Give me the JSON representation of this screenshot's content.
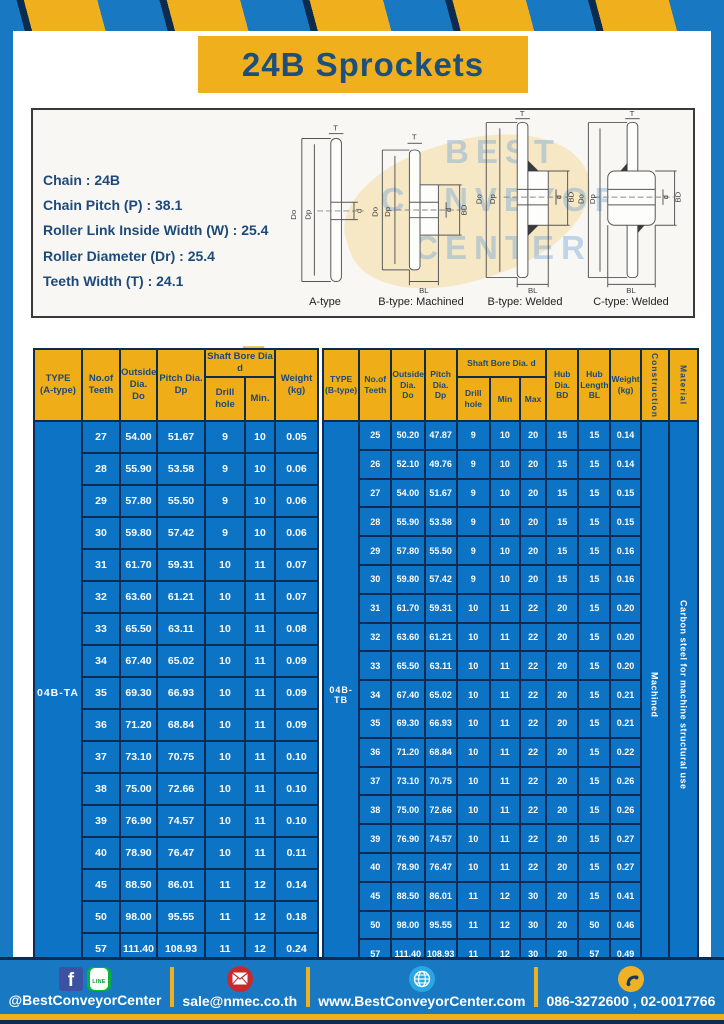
{
  "title": "24B Sprockets",
  "specs": {
    "lines": [
      "Chain : 24B",
      "Chain Pitch (P) : 38.1",
      "Roller Link Inside Width (W) : 25.4",
      "Roller Diameter (Dr) : 25.4",
      "Teeth Width (T) : 24.1"
    ]
  },
  "dims": {
    "t": "T",
    "do": "Do",
    "dp": "Dp",
    "d": "d",
    "bd": "BD",
    "bl": "BL"
  },
  "diagrams": {
    "captions": [
      "A-type",
      "B-type: Machined",
      "B-type: Welded",
      "C-type: Welded"
    ]
  },
  "watermark": {
    "lines": [
      "BEST",
      "CONVEYOR",
      "CENTER"
    ],
    "mail_glyph": "✉"
  },
  "tables": {
    "left": {
      "type_label": "04B-TA",
      "headers": {
        "type": "TYPE\n(A-type)",
        "teeth": "No.of\nTeeth",
        "outside": "Outside\nDia.\nDo",
        "pitch": "Pitch Dia.\nDp",
        "bore_group": "Shaft Bore Dia d",
        "drill": "Drill hole",
        "min": "Min.",
        "weight": "Weight\n(kg)"
      },
      "rows": [
        [
          "27",
          "54.00",
          "51.67",
          "9",
          "10",
          "0.05"
        ],
        [
          "28",
          "55.90",
          "53.58",
          "9",
          "10",
          "0.06"
        ],
        [
          "29",
          "57.80",
          "55.50",
          "9",
          "10",
          "0.06"
        ],
        [
          "30",
          "59.80",
          "57.42",
          "9",
          "10",
          "0.06"
        ],
        [
          "31",
          "61.70",
          "59.31",
          "10",
          "11",
          "0.07"
        ],
        [
          "32",
          "63.60",
          "61.21",
          "10",
          "11",
          "0.07"
        ],
        [
          "33",
          "65.50",
          "63.11",
          "10",
          "11",
          "0.08"
        ],
        [
          "34",
          "67.40",
          "65.02",
          "10",
          "11",
          "0.09"
        ],
        [
          "35",
          "69.30",
          "66.93",
          "10",
          "11",
          "0.09"
        ],
        [
          "36",
          "71.20",
          "68.84",
          "10",
          "11",
          "0.09"
        ],
        [
          "37",
          "73.10",
          "70.75",
          "10",
          "11",
          "0.10"
        ],
        [
          "38",
          "75.00",
          "72.66",
          "10",
          "11",
          "0.10"
        ],
        [
          "39",
          "76.90",
          "74.57",
          "10",
          "11",
          "0.10"
        ],
        [
          "40",
          "78.90",
          "76.47",
          "10",
          "11",
          "0.11"
        ],
        [
          "45",
          "88.50",
          "86.01",
          "11",
          "12",
          "0.14"
        ],
        [
          "50",
          "98.00",
          "95.55",
          "11",
          "12",
          "0.18"
        ],
        [
          "57",
          "111.40",
          "108.93",
          "11",
          "12",
          "0.24"
        ]
      ]
    },
    "right": {
      "type_label": "04B-TB",
      "construction": "Machined",
      "material": "Carbon steel for machine structural use",
      "headers": {
        "type": "TYPE\n(B-type)",
        "teeth": "No.of\nTeeth",
        "outside": "Outside\nDia.\nDo",
        "pitch": "Pitch\nDia.\nDp",
        "bore_group": "Shaft Bore Dia. d",
        "drill": "Drill hole",
        "min": "Min",
        "max": "Max",
        "hub_dia": "Hub\nDia.\nBD",
        "hub_len": "Hub\nLength\nBL",
        "weight": "Weight\n(kg)",
        "construction": "Construction",
        "material": "Material"
      },
      "rows": [
        [
          "25",
          "50.20",
          "47.87",
          "9",
          "10",
          "20",
          "15",
          "15",
          "0.14"
        ],
        [
          "26",
          "52.10",
          "49.76",
          "9",
          "10",
          "20",
          "15",
          "15",
          "0.14"
        ],
        [
          "27",
          "54.00",
          "51.67",
          "9",
          "10",
          "20",
          "15",
          "15",
          "0.15"
        ],
        [
          "28",
          "55.90",
          "53.58",
          "9",
          "10",
          "20",
          "15",
          "15",
          "0.15"
        ],
        [
          "29",
          "57.80",
          "55.50",
          "9",
          "10",
          "20",
          "15",
          "15",
          "0.16"
        ],
        [
          "30",
          "59.80",
          "57.42",
          "9",
          "10",
          "20",
          "15",
          "15",
          "0.16"
        ],
        [
          "31",
          "61.70",
          "59.31",
          "10",
          "11",
          "22",
          "20",
          "15",
          "0.20"
        ],
        [
          "32",
          "63.60",
          "61.21",
          "10",
          "11",
          "22",
          "20",
          "15",
          "0.20"
        ],
        [
          "33",
          "65.50",
          "63.11",
          "10",
          "11",
          "22",
          "20",
          "15",
          "0.20"
        ],
        [
          "34",
          "67.40",
          "65.02",
          "10",
          "11",
          "22",
          "20",
          "15",
          "0.21"
        ],
        [
          "35",
          "69.30",
          "66.93",
          "10",
          "11",
          "22",
          "20",
          "15",
          "0.21"
        ],
        [
          "36",
          "71.20",
          "68.84",
          "10",
          "11",
          "22",
          "20",
          "15",
          "0.22"
        ],
        [
          "37",
          "73.10",
          "70.75",
          "10",
          "11",
          "22",
          "20",
          "15",
          "0.26"
        ],
        [
          "38",
          "75.00",
          "72.66",
          "10",
          "11",
          "22",
          "20",
          "15",
          "0.26"
        ],
        [
          "39",
          "76.90",
          "74.57",
          "10",
          "11",
          "22",
          "20",
          "15",
          "0.27"
        ],
        [
          "40",
          "78.90",
          "76.47",
          "10",
          "11",
          "22",
          "20",
          "15",
          "0.27"
        ],
        [
          "45",
          "88.50",
          "86.01",
          "11",
          "12",
          "30",
          "20",
          "15",
          "0.41"
        ],
        [
          "50",
          "98.00",
          "95.55",
          "11",
          "12",
          "30",
          "20",
          "50",
          "0.46"
        ],
        [
          "57",
          "111.40",
          "108.93",
          "11",
          "12",
          "30",
          "20",
          "57",
          "0.49"
        ]
      ]
    }
  },
  "footer": {
    "social": "@BestConveyorCenter",
    "email": "sale@nmec.co.th",
    "website": "www.BestConveyorCenter.com",
    "phone": "086-3272600 , 02-0017766"
  },
  "icons": {
    "facebook_letter": "f",
    "line_text": "LINE"
  },
  "colors": {
    "frame_blue": "#1878c2",
    "cell_blue": "#0d73c4",
    "accent_yellow": "#f0b01e",
    "navy": "#0e2c52",
    "heading_navy": "#1d4f7c"
  }
}
